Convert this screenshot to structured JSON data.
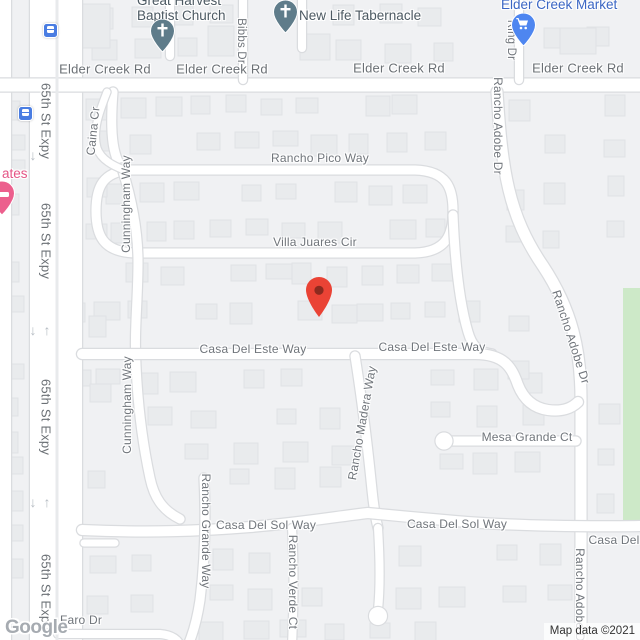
{
  "attribution": {
    "map_data": "Map data ©2021",
    "logo": "Google"
  },
  "streets": {
    "elder_creek_rd": "Elder Creek Rd",
    "s65th_st_expy": "65th St Expy",
    "rancho_pico_way": "Rancho Pico Way",
    "villa_juares_cir": "Villa Juares Cir",
    "casa_del_este_way": "Casa Del Este Way",
    "mesa_grande_ct": "Mesa Grande Ct",
    "casa_del_sol_way": "Casa Del Sol Way",
    "casa_del_partial": "Casa Del",
    "cunningham_way": "Cunningham Way",
    "caina_cr": "Caina Cr",
    "bibbs_dr": "Bibbs Dr",
    "ring_dr": "Ring Dr",
    "rancho_adobe_dr": "Rancho Adobe Dr",
    "rancho_grande_way": "Rancho Grande Way",
    "rancho_verde_ct": "Rancho Verde Ct",
    "rancho_madera_way": "Rancho Madera Way",
    "faro_dr": "Faro Dr"
  },
  "pois": {
    "baptist_church": {
      "line1": "Great Harvest",
      "line2": "Baptist Church",
      "icon": "worship-pin"
    },
    "tabernacle": {
      "name": "New Life Tabernacle",
      "icon": "worship-pin"
    },
    "market": {
      "name": "Elder Creek Market",
      "icon": "shopping-pin"
    },
    "lodging_partial": {
      "name": "ates",
      "icon": "lodging-pin"
    }
  },
  "glyphs": {
    "arrow_up": "↑",
    "arrow_down": "↓"
  },
  "colors": {
    "marker_red": "#ea4335",
    "shopping_pin_blue": "#4e86f0",
    "shopping_text_blue": "#3b66c4",
    "worship_slate": "#5f7c8a",
    "lodging_pink": "#ec5f8d",
    "transit_blue": "#4a7de2",
    "park_green": "#cde9c8",
    "road_white": "#ffffff",
    "map_bg": "#f0f1f3"
  }
}
